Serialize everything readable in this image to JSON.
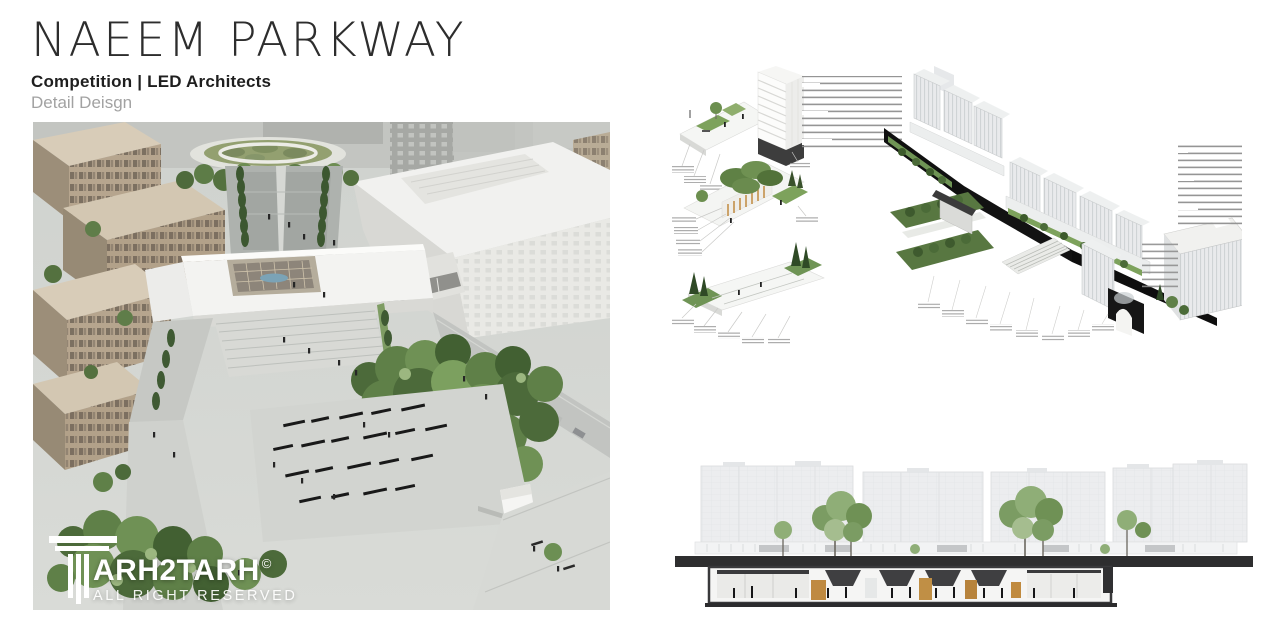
{
  "header": {
    "title": "NAEEM PARKWAY",
    "subtitle": "Competition | LED Architects",
    "detail": "Detail Deisgn"
  },
  "watermark": {
    "brand": "ARH2TARH",
    "copyright": "©",
    "tagline": "ALL RIGHT RESERVED"
  },
  "figures": {
    "aerial_render": "Aerial rendering of Naeem Parkway plaza and surrounding blocks",
    "axonometric_diagrams": "Axonometric streetscape detail diagrams with Farsi annotations",
    "section_elevation": "Longitudinal section-elevation through the parkway"
  },
  "colors": {
    "title_text": "#2d2d2d",
    "muted_text": "#a2a2a2",
    "section_cut_black": "#111111",
    "vegetation_green": "#6f9152",
    "timber_accent": "#c08a3f",
    "building_beige": "#b5a48d",
    "watermark_white": "#ffffff"
  }
}
